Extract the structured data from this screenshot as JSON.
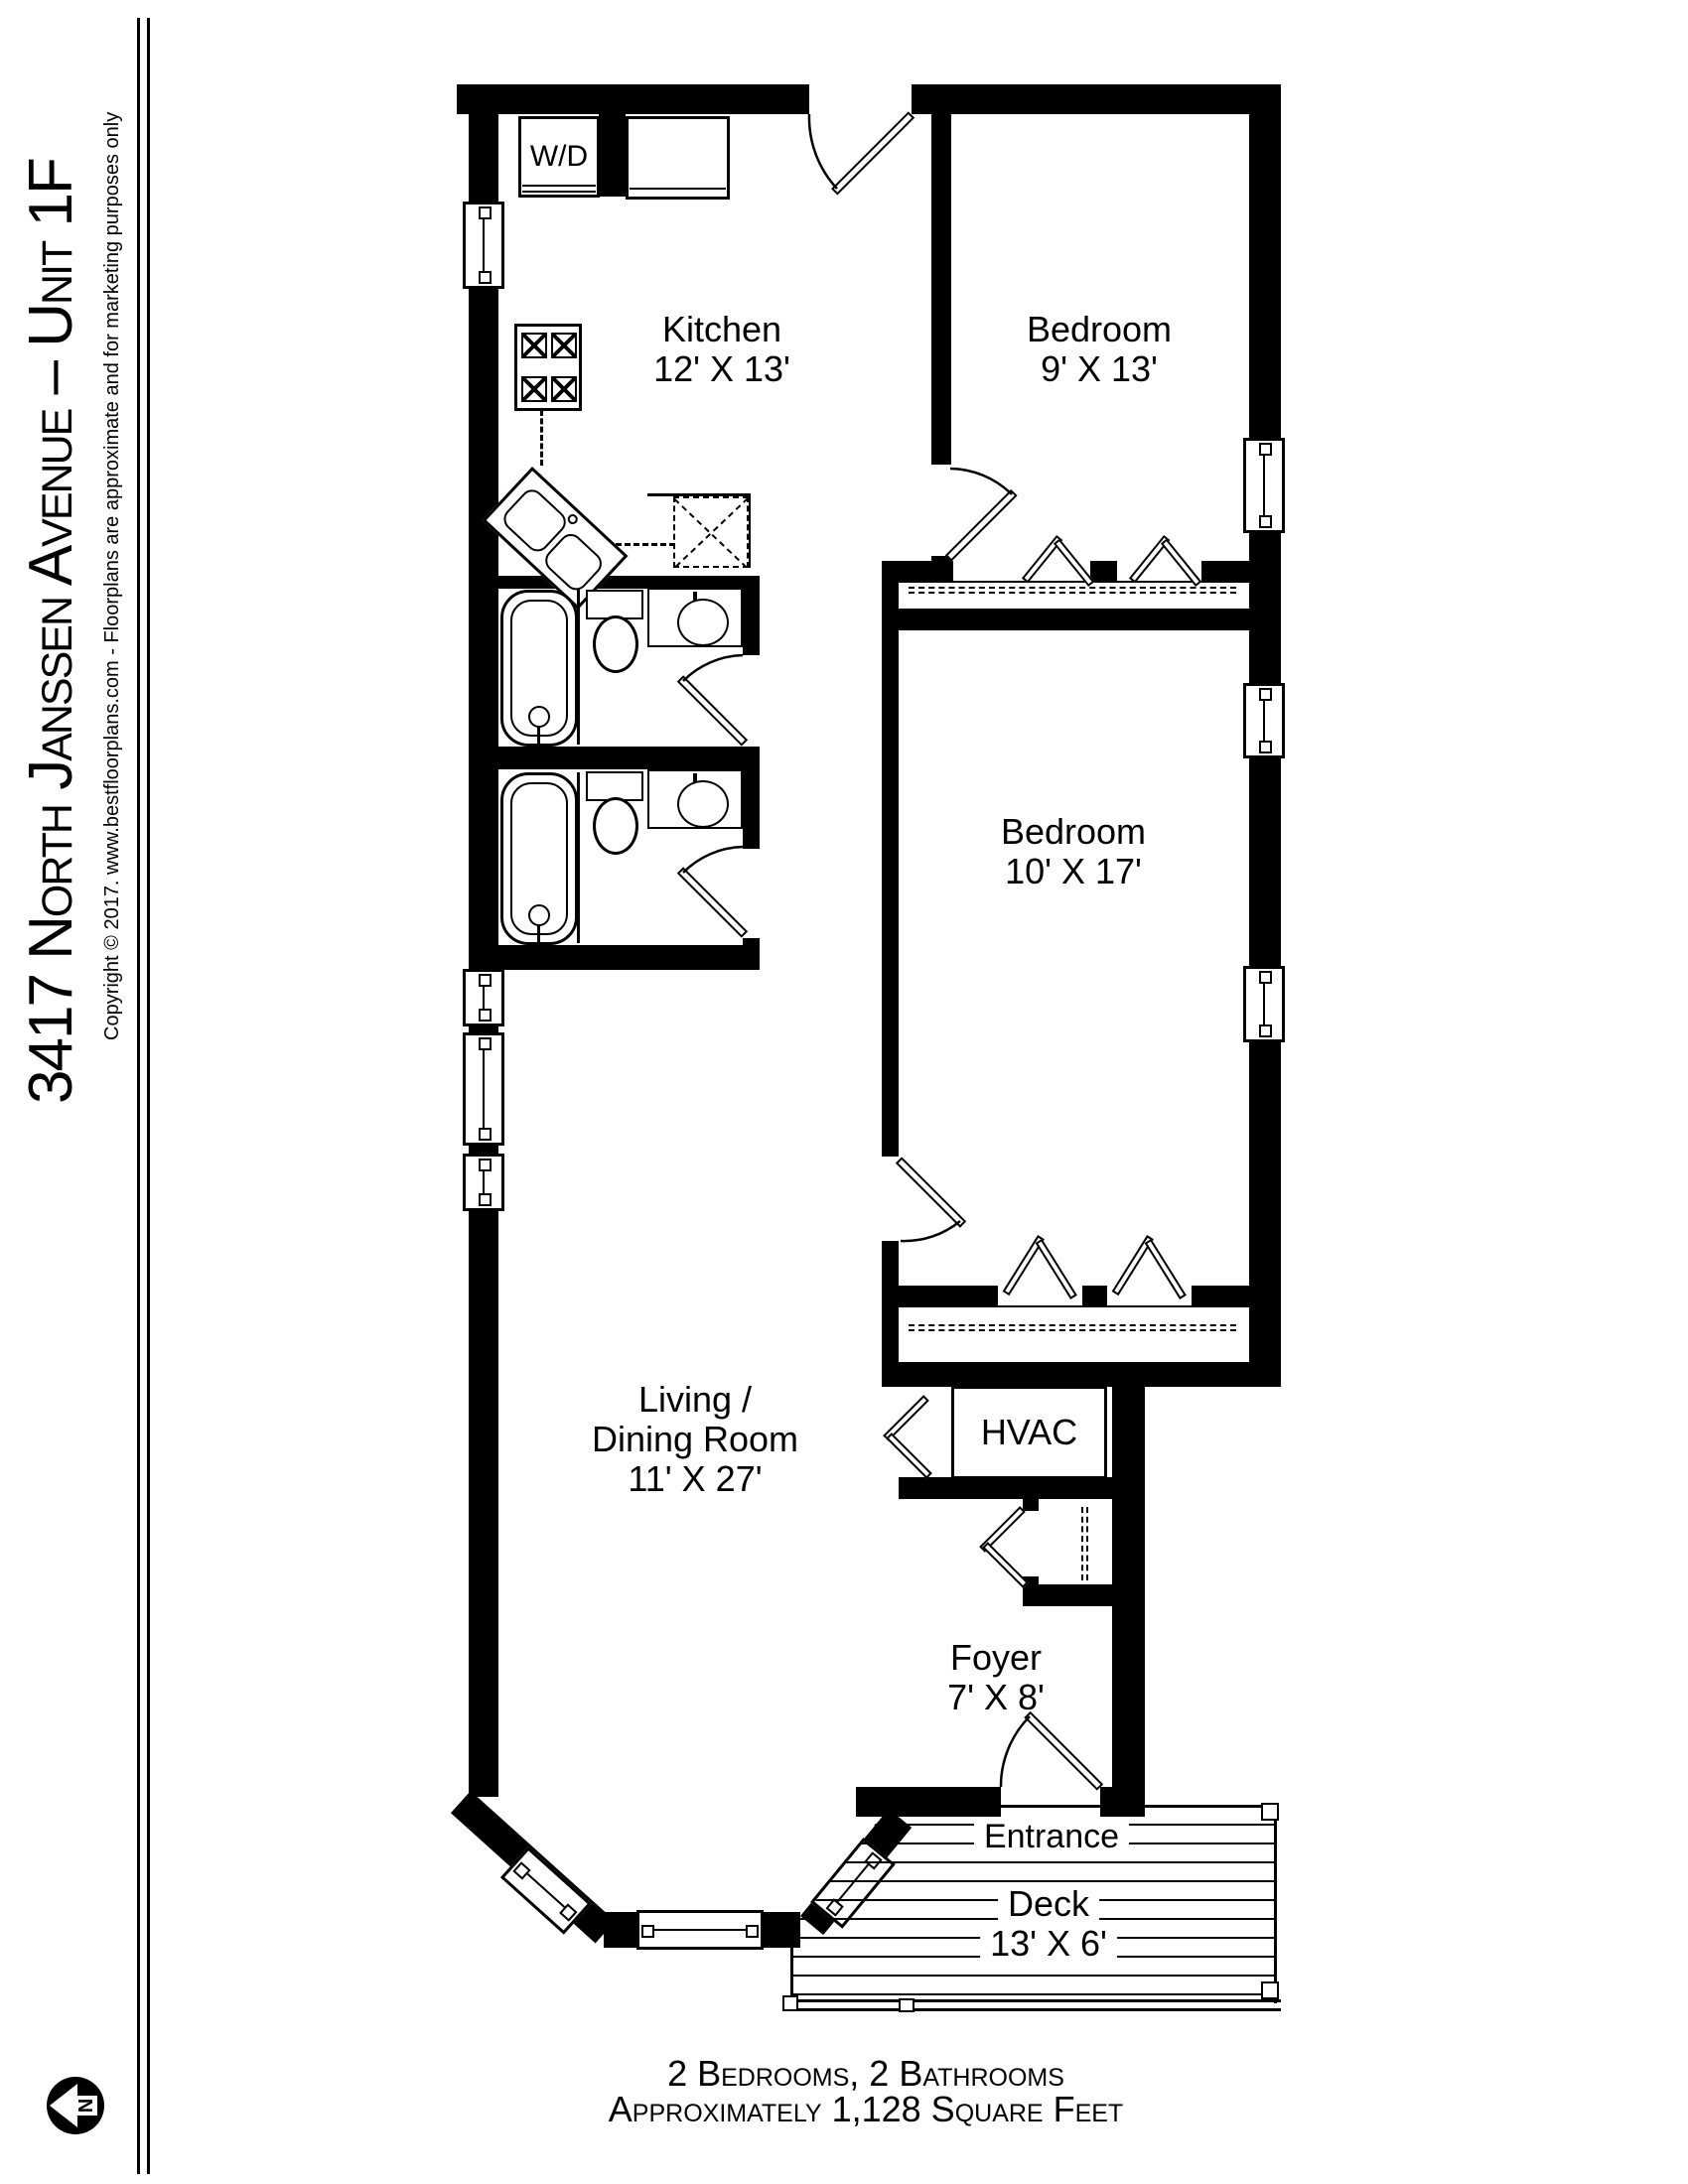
{
  "sidebar": {
    "title": "3417 North Janssen Avenue – Unit 1F",
    "copyright": "Copyright © 2017. www.bestfloorplans.com - Floorplans are approximate and for marketing purposes only",
    "compass_n": "N"
  },
  "plan": {
    "kitchen": {
      "name": "Kitchen",
      "dims": "12' X 13'"
    },
    "bedroom_top": {
      "name": "Bedroom",
      "dims": "9' X 13'"
    },
    "bedroom_middle": {
      "name": "Bedroom",
      "dims": "10' X 17'"
    },
    "living_dining": {
      "line1": "Living /",
      "line2": "Dining Room",
      "dims": "11' X 27'"
    },
    "foyer": {
      "name": "Foyer",
      "dims": "7' X 8'"
    },
    "deck": {
      "name": "Deck",
      "dims": "13' X 6'"
    },
    "hvac_label": "HVAC",
    "washer_dryer_label": "W/D",
    "entrance_label": "Entrance"
  },
  "footer": {
    "line1": "2 Bedrooms, 2 Bathrooms",
    "line2": "Approximately 1,128 Square Feet"
  },
  "colors": {
    "wall": "#000000",
    "bg": "#ffffff"
  }
}
